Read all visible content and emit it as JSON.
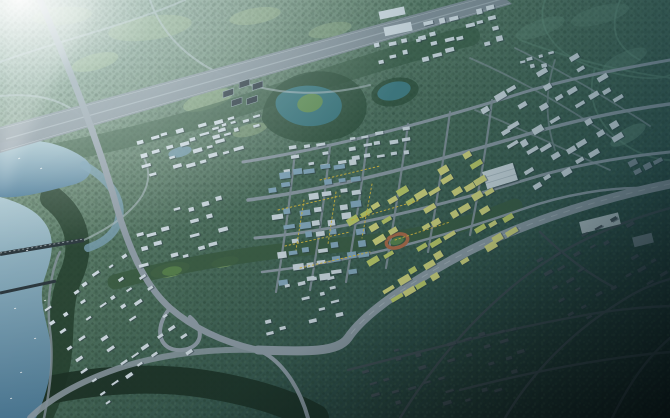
{
  "meta": {
    "description": "Aerial bird's-eye rendering of a planned city district: a central low-rise core with white, blue-glass and yellow building blocks, surrounded by forest, meadows, teal ponds, a lake and river on the west, a straight expressway across the north, a sweeping arc expressway on the southeast, and dark vignetted residential forest blocks toward the lower right with sun glare in the upper left."
  },
  "palette": {
    "meadow": "#a3bf8f",
    "meadowBright": "#8db468",
    "tealMeadow": "#6f9c85",
    "forestBandN": "#3a5d45",
    "forestBlob": "#2f5039",
    "forestRiver": "#27422f",
    "forestSouth": "#1e3326",
    "greenway": "#3f6144",
    "waterLake": "#a9c6d0",
    "waterDeep": "#4f7e9b",
    "waterPond": "#3f7d84",
    "waterPond2": "#46838a",
    "waterCanal": "#7fa6ba",
    "island": "#69985a",
    "roadLight": "#b9c7cd",
    "roadMid": "#98a4ae",
    "roadAvenue": "#96a2ac",
    "roadCross": "#8f9ba5",
    "roadDark": "#49545b",
    "highway": "#8b97a1",
    "highwayMedian": "#aebac2",
    "bridge": "#2e3a40",
    "bldgWhite": "#dde7ee",
    "bldgBlue": "#8fb2c8",
    "bldgYellow": "#e3e382",
    "bldgLime": "#ccd96b",
    "bldgGray": "#8a98a2",
    "bldgDim": "#4c565e",
    "bldgShadow": "#2e3a46",
    "streetLight": "#eac73f",
    "trackOrange": "#bd6f49",
    "pitchGreen": "#5f8b4f",
    "solarDark": "#2b3740",
    "boat": "#f2f6f8"
  },
  "scene": {
    "clusters": [
      {
        "name": "north-terrace-rows",
        "cx": 190,
        "cy": 146,
        "w": 104,
        "h": 44,
        "rot": -16,
        "cols": 8,
        "rows": 4,
        "bw": 8,
        "bh": 3.2,
        "fill": "bldgWhite",
        "p": 0.8,
        "seed": 1
      },
      {
        "name": "north-villas",
        "cx": 236,
        "cy": 127,
        "w": 54,
        "h": 16,
        "rot": -16,
        "cols": 5,
        "rows": 2,
        "bw": 6,
        "bh": 3,
        "fill": "bldgWhite",
        "p": 0.75,
        "seed": 2
      },
      {
        "name": "northeast-campus",
        "cx": 459,
        "cy": 33,
        "w": 88,
        "h": 42,
        "rot": -14,
        "cols": 7,
        "rows": 4,
        "bw": 7.5,
        "bh": 4.2,
        "fill": "bldgWhite",
        "p": 0.8,
        "seed": 3
      },
      {
        "name": "north-scatter",
        "cx": 385,
        "cy": 52,
        "w": 80,
        "h": 26,
        "rot": -12,
        "cols": 6,
        "rows": 2,
        "bw": 6,
        "bh": 3.4,
        "fill": "bldgWhite",
        "p": 0.6,
        "seed": 4
      },
      {
        "name": "far-north-hamlet",
        "cx": 537,
        "cy": 62,
        "w": 40,
        "h": 18,
        "rot": -14,
        "cols": 4,
        "rows": 2,
        "bw": 5.5,
        "bh": 3,
        "fill": "bldgWhite",
        "p": 0.7,
        "seed": 15
      },
      {
        "name": "lakeside-offices",
        "cx": 345,
        "cy": 150,
        "w": 140,
        "h": 30,
        "rot": -9,
        "cols": 10,
        "rows": 3,
        "bw": 7,
        "bh": 3.2,
        "fill": "bldgWhite",
        "p": 0.65,
        "seed": 5
      },
      {
        "name": "downtown-core",
        "cx": 318,
        "cy": 222,
        "w": 96,
        "h": 120,
        "rot": -8,
        "cols": 7,
        "rows": 9,
        "bw": 9,
        "bh": 5,
        "fill": [
          "bldgWhite",
          "bldgBlue",
          "bldgBlue",
          "bldgWhite"
        ],
        "p": 0.82,
        "seed": 6
      },
      {
        "name": "innovation-district",
        "cx": 432,
        "cy": 226,
        "w": 150,
        "h": 105,
        "rot": -31,
        "cols": 10,
        "rows": 7,
        "bw": 10,
        "bh": 5.5,
        "fill": [
          "bldgYellow",
          "bldgLime",
          "bldgYellow"
        ],
        "p": 0.72,
        "seed": 7
      },
      {
        "name": "east-industrial-park",
        "cx": 560,
        "cy": 118,
        "w": 130,
        "h": 110,
        "rot": -31,
        "cols": 8,
        "rows": 7,
        "bw": 9.5,
        "bh": 5,
        "fill": "bldgWhite",
        "p": 0.66,
        "seed": 8
      },
      {
        "name": "east-midrise",
        "cx": 645,
        "cy": 162,
        "w": 34,
        "h": 18,
        "rot": -28,
        "cols": 3,
        "rows": 2,
        "bw": 8,
        "bh": 4.5,
        "fill": "bldgGray",
        "p": 0.9,
        "seed": 9
      },
      {
        "name": "riverside-blocks",
        "cx": 182,
        "cy": 232,
        "w": 100,
        "h": 58,
        "rot": -15,
        "cols": 7,
        "rows": 4,
        "bw": 7.5,
        "bh": 3.4,
        "fill": "bldgWhite",
        "p": 0.68,
        "seed": 10
      },
      {
        "name": "west-residential",
        "cx": 118,
        "cy": 330,
        "w": 112,
        "h": 128,
        "rot": -34,
        "cols": 7,
        "rows": 9,
        "bw": 6.5,
        "bh": 2.8,
        "fill": "bldgWhite",
        "p": 0.62,
        "seed": 11
      },
      {
        "name": "parkside-homes",
        "cx": 300,
        "cy": 305,
        "w": 90,
        "h": 55,
        "rot": -14,
        "cols": 6,
        "rows": 4,
        "bw": 6.5,
        "bh": 3,
        "fill": "bldgWhite",
        "p": 0.55,
        "seed": 12
      },
      {
        "name": "south-dim-residential",
        "cx": 448,
        "cy": 368,
        "w": 170,
        "h": 82,
        "rot": -17,
        "cols": 10,
        "rows": 6,
        "bw": 7,
        "bh": 2.8,
        "fill": "bldgDim",
        "p": 0.6,
        "seed": 13
      },
      {
        "name": "east-dim-residential",
        "cx": 602,
        "cy": 268,
        "w": 115,
        "h": 88,
        "rot": -30,
        "cols": 7,
        "rows": 6,
        "bw": 7,
        "bh": 2.8,
        "fill": "bldgDim",
        "p": 0.55,
        "seed": 14
      }
    ]
  }
}
